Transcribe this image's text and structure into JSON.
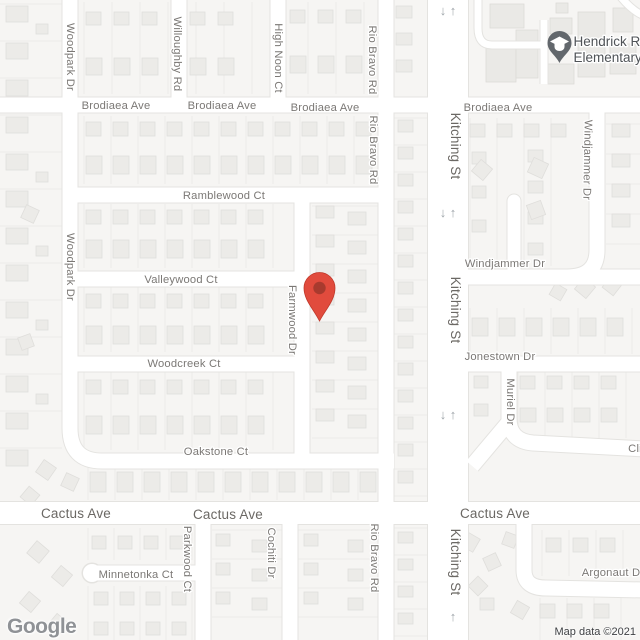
{
  "map": {
    "logo": "Google",
    "attribution": "Map data ©2021",
    "colors": {
      "land": "#F6F5F3",
      "road_fill": "#FFFFFF",
      "road_casing": "#E4E3E0",
      "lot_line": "#ECEBE9",
      "house_fill": "#ECEBE8",
      "house_stroke": "#DFDEDB",
      "school_building_fill": "#EAE9E6",
      "school_building_stroke": "#DCDBD8",
      "label": "#7B7875",
      "major_label": "#6B6864",
      "arrow": "#9FA5AA",
      "marker_red": "#E14B3D",
      "marker_red_inner": "#A83A2E",
      "marker_red_stroke": "#C0392B",
      "school_pin": "#62676C",
      "poi_label": "#4F5357"
    },
    "marker": {
      "title": "dropped-pin",
      "x": 319.5,
      "y": 321
    },
    "school_poi": {
      "line1": "Hendrick R",
      "line2": "Elementary",
      "x": 559.5,
      "y": 63
    },
    "labels": [
      {
        "name": "brodiaea-ave-1",
        "text": "Brodiaea Ave",
        "x": 116,
        "y": 109,
        "rot": 0,
        "major": false
      },
      {
        "name": "brodiaea-ave-2",
        "text": "Brodiaea Ave",
        "x": 222,
        "y": 109,
        "rot": 0,
        "major": false
      },
      {
        "name": "brodiaea-ave-3",
        "text": "Brodiaea Ave",
        "x": 325,
        "y": 111,
        "rot": 0,
        "major": false
      },
      {
        "name": "brodiaea-ave-4",
        "text": "Brodiaea Ave",
        "x": 498,
        "y": 111,
        "rot": 0,
        "major": false
      },
      {
        "name": "ramblewood-ct",
        "text": "Ramblewood Ct",
        "x": 224,
        "y": 199,
        "rot": 0,
        "major": false
      },
      {
        "name": "valleywood-ct",
        "text": "Valleywood Ct",
        "x": 181,
        "y": 283,
        "rot": 0,
        "major": false
      },
      {
        "name": "woodcreek-ct",
        "text": "Woodcreek Ct",
        "x": 184,
        "y": 367,
        "rot": 0,
        "major": false
      },
      {
        "name": "oakstone-ct",
        "text": "Oakstone Ct",
        "x": 216,
        "y": 455,
        "rot": 0,
        "major": false
      },
      {
        "name": "cactus-ave-1",
        "text": "Cactus Ave",
        "x": 76,
        "y": 518,
        "rot": 0,
        "major": true
      },
      {
        "name": "cactus-ave-2",
        "text": "Cactus Ave",
        "x": 228,
        "y": 519,
        "rot": 0,
        "major": true
      },
      {
        "name": "cactus-ave-3",
        "text": "Cactus Ave",
        "x": 495,
        "y": 518,
        "rot": 0,
        "major": true
      },
      {
        "name": "minnetonka-ct",
        "text": "Minnetonka Ct",
        "x": 136,
        "y": 578,
        "rot": 0,
        "major": false
      },
      {
        "name": "windjammer-dr-h",
        "text": "Windjammer Dr",
        "x": 505,
        "y": 267,
        "rot": 0,
        "major": false
      },
      {
        "name": "jonestown-dr",
        "text": "Jonestown Dr",
        "x": 500,
        "y": 360,
        "rot": 0,
        "major": false
      },
      {
        "name": "argonaut-dr",
        "text": "Argonaut Dr",
        "x": 613,
        "y": 576,
        "rot": 0,
        "major": false
      },
      {
        "name": "cli-street",
        "text": "Cli",
        "x": 635,
        "y": 452,
        "rot": 0,
        "major": false
      },
      {
        "name": "woodpark-dr-1",
        "text": "Woodpark Dr",
        "x": 71,
        "y": 57,
        "rot": 90,
        "major": false
      },
      {
        "name": "woodpark-dr-2",
        "text": "Woodpark Dr",
        "x": 71,
        "y": 267,
        "rot": 90,
        "major": false
      },
      {
        "name": "willoughby-rd",
        "text": "Willoughby Rd",
        "x": 178,
        "y": 54,
        "rot": 90,
        "major": false
      },
      {
        "name": "high-noon-ct",
        "text": "High Noon Ct",
        "x": 279,
        "y": 58,
        "rot": 90,
        "major": false
      },
      {
        "name": "rio-bravo-rd-1",
        "text": "Rio Bravo Rd",
        "x": 373,
        "y": 60,
        "rot": 90,
        "major": false
      },
      {
        "name": "rio-bravo-rd-2",
        "text": "Rio Bravo Rd",
        "x": 374,
        "y": 150,
        "rot": 90,
        "major": false
      },
      {
        "name": "rio-bravo-rd-3",
        "text": "Rio Bravo Rd",
        "x": 375,
        "y": 558,
        "rot": 90,
        "major": false
      },
      {
        "name": "kitching-st-1",
        "text": "Kitching St",
        "x": 455,
        "y": 146,
        "rot": 90,
        "major": true
      },
      {
        "name": "kitching-st-2",
        "text": "Kitching St",
        "x": 455,
        "y": 310,
        "rot": 90,
        "major": true
      },
      {
        "name": "kitching-st-3",
        "text": "Kitching St",
        "x": 455,
        "y": 562,
        "rot": 90,
        "major": true
      },
      {
        "name": "windjammer-dr-v",
        "text": "Windjammer Dr",
        "x": 588,
        "y": 160,
        "rot": 91,
        "major": false
      },
      {
        "name": "farmwood-dr",
        "text": "Farmwood Dr",
        "x": 293,
        "y": 320,
        "rot": 90,
        "major": false
      },
      {
        "name": "muriel-dr",
        "text": "Muriel Dr",
        "x": 511,
        "y": 402,
        "rot": 90,
        "major": false
      },
      {
        "name": "parkwood-ct",
        "text": "Parkwood Ct",
        "x": 188,
        "y": 559,
        "rot": 90,
        "major": false
      },
      {
        "name": "cochiti-dr",
        "text": "Cochiti Dr",
        "x": 272,
        "y": 553,
        "rot": 90,
        "major": false
      }
    ],
    "arrows": [
      {
        "g": "↓",
        "x": 443,
        "y": 15
      },
      {
        "g": "↑",
        "x": 453,
        "y": 15
      },
      {
        "g": "↓",
        "x": 443,
        "y": 217
      },
      {
        "g": "↑",
        "x": 453,
        "y": 217
      },
      {
        "g": "↓",
        "x": 443,
        "y": 419
      },
      {
        "g": "↑",
        "x": 453,
        "y": 419
      },
      {
        "g": "↑",
        "x": 453,
        "y": 621
      },
      {
        "g": "↓",
        "x": 443,
        "y": 649
      },
      {
        "g": "↑",
        "x": 453,
        "y": 649
      }
    ]
  }
}
